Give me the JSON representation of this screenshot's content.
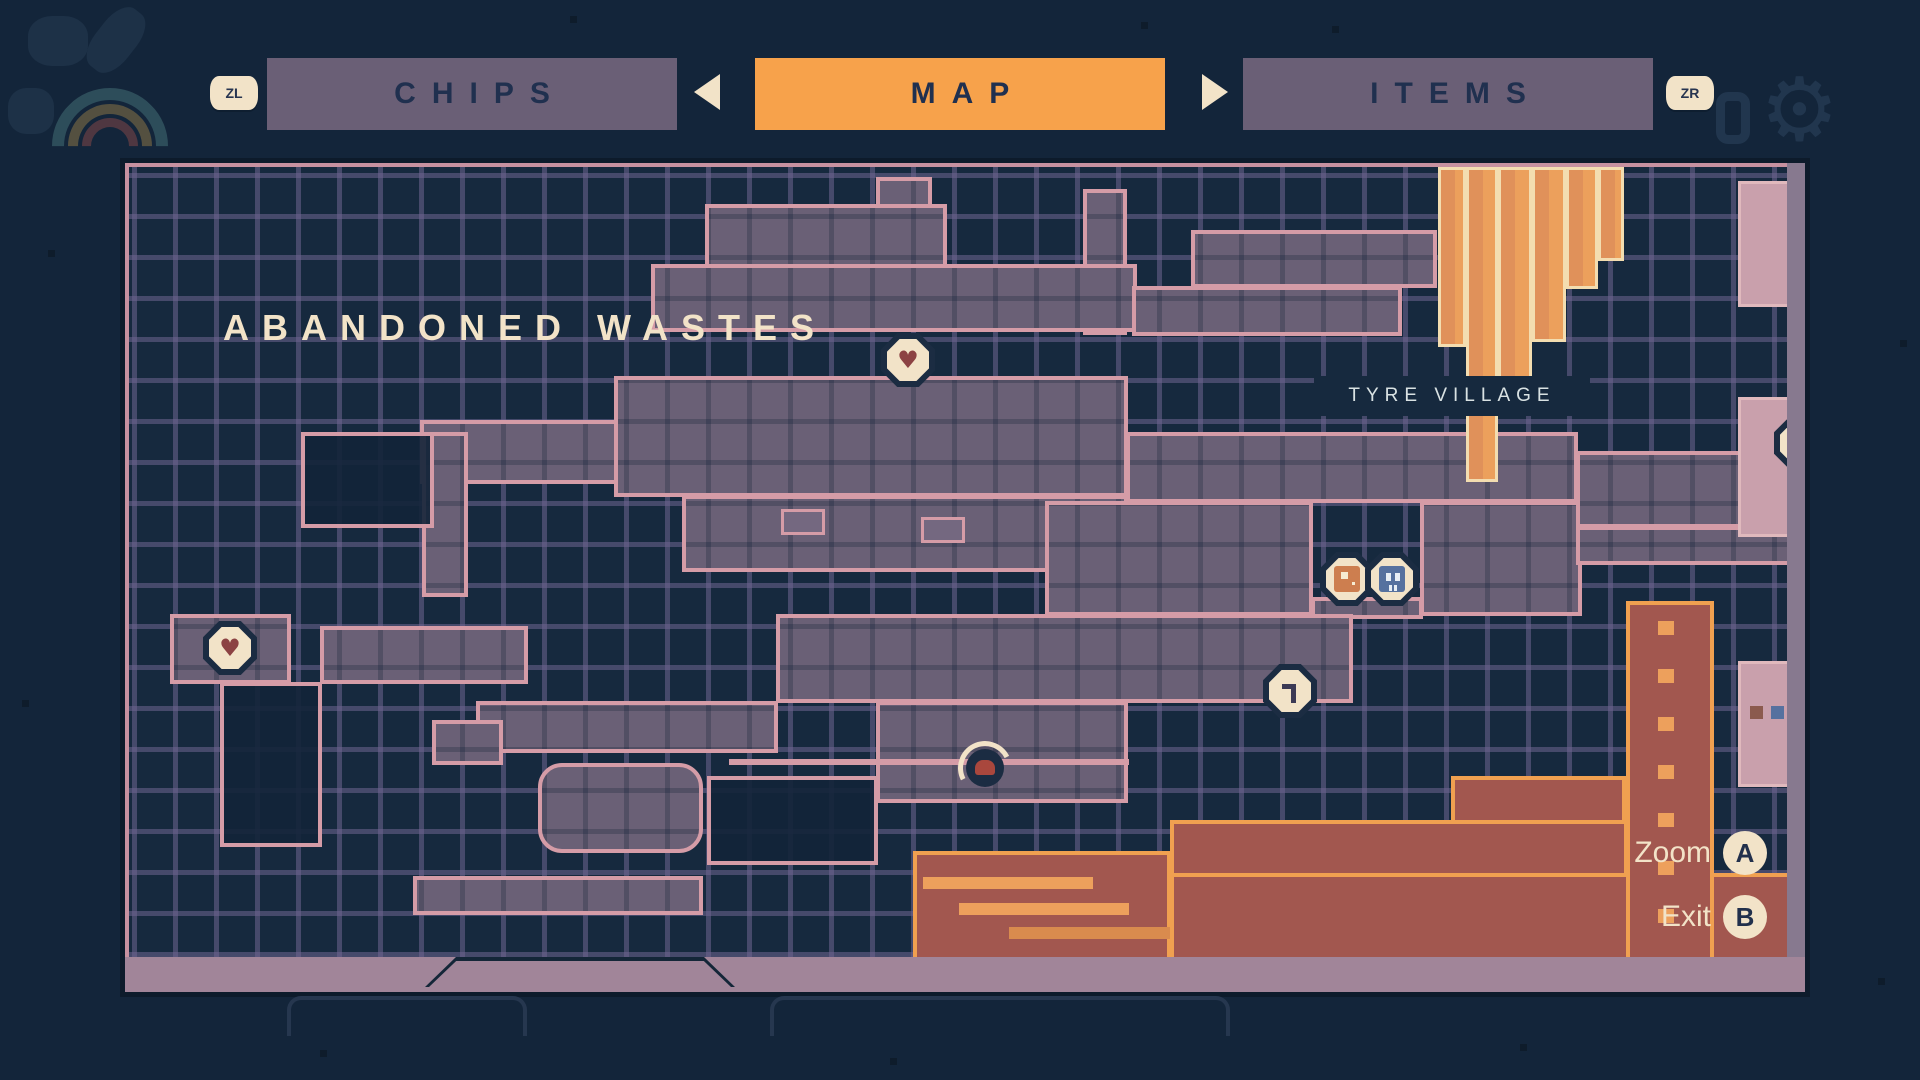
{
  "tab_bar": {
    "left_shoulder_label": "ZL",
    "right_shoulder_label": "ZR",
    "tabs": [
      {
        "label": "CHIPS",
        "active": false
      },
      {
        "label": "MAP",
        "active": true
      },
      {
        "label": "ITEMS",
        "active": false
      }
    ],
    "icons": {
      "prev": "arrow-left-icon",
      "next": "arrow-right-icon"
    }
  },
  "background_decorations": {
    "icons": [
      "splash-logo-icon",
      "counter-zero-icon",
      "gear-icon"
    ]
  },
  "map_panel": {
    "region_title": "ABANDONED WASTES",
    "location_label": "TYRE VILLAGE",
    "markers": [
      {
        "type": "heart",
        "meaning": "health-upgrade",
        "x": 779,
        "y": 193
      },
      {
        "type": "heart",
        "meaning": "health-upgrade",
        "x": 101,
        "y": 481
      },
      {
        "type": "shop",
        "meaning": "chip-shop",
        "x": 1218,
        "y": 412
      },
      {
        "type": "save",
        "meaning": "save-station",
        "x": 1263,
        "y": 412
      },
      {
        "type": "key",
        "meaning": "locked-lever",
        "x": 1161,
        "y": 524
      },
      {
        "type": "player",
        "meaning": "current-position",
        "x": 856,
        "y": 601
      },
      {
        "type": "heart",
        "meaning": "health-upgrade",
        "x": 1672,
        "y": 276
      }
    ]
  },
  "controls": [
    {
      "action": "Zoom",
      "button": "A"
    },
    {
      "action": "Exit",
      "button": "B"
    }
  ],
  "colors": {
    "bg": "#13253a",
    "map-bg": "#16293e",
    "accent": "#f7a24b",
    "tab-inactive": "#6a5f76",
    "cream": "#f2e3c8",
    "room": "#6a6076",
    "room-edge": "#d59ca7",
    "zone-red": "#a2574f",
    "zone-red-edge": "#f0a050",
    "zone-orange": "#eca05c"
  }
}
